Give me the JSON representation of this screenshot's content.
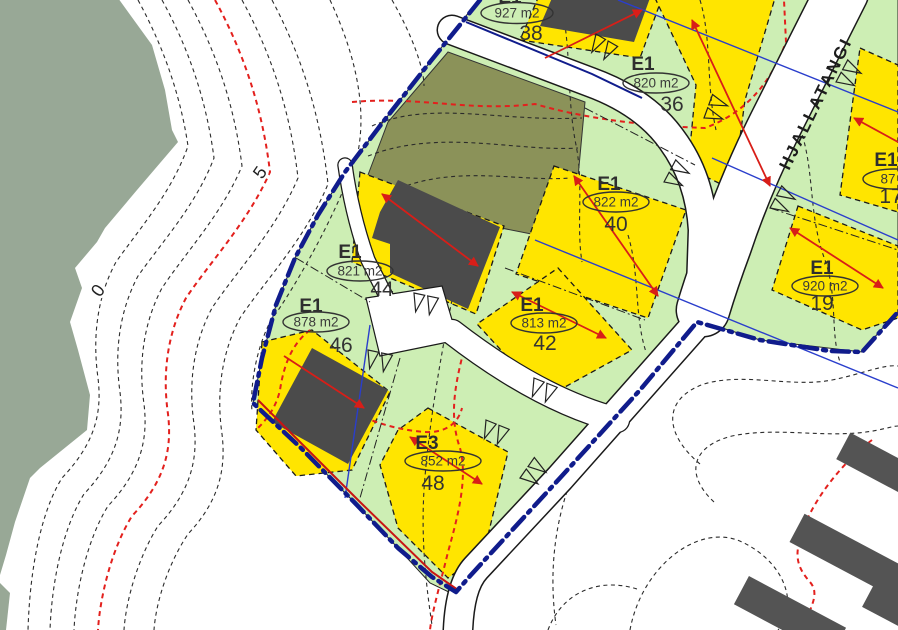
{
  "map": {
    "street": {
      "name": "HJALLATANGI"
    },
    "contour_labels": {
      "zero": "0",
      "five": "5"
    },
    "plots": [
      {
        "number": "38",
        "zone": "E1",
        "area": "927 m2"
      },
      {
        "number": "36",
        "zone": "E1",
        "area": "820 m2"
      },
      {
        "number": "40",
        "zone": "E1",
        "area": "822 m2"
      },
      {
        "number": "44",
        "zone": "E1",
        "area": "821 m2"
      },
      {
        "number": "46",
        "zone": "E1",
        "area": "878 m2"
      },
      {
        "number": "42",
        "zone": "E1",
        "area": "813 m2"
      },
      {
        "number": "48",
        "zone": "E3",
        "area": "852 m2"
      },
      {
        "number": "19",
        "zone": "E1",
        "area": "920 m2"
      },
      {
        "number": "17",
        "zone": "E1",
        "area": "87"
      }
    ],
    "legend_colors": {
      "residential_lot_green": "#cdeeb4",
      "building_area_yellow": "#ffe500",
      "open_space_olive": "#8b9259",
      "sea_gray_green": "#98a896",
      "plan_boundary_navy": "#101c8c",
      "contour_red": "#e3201d",
      "existing_building_gray": "#4b4b4b",
      "utility_line_blue": "#2a3ecc",
      "road_white": "#ffffff"
    }
  }
}
